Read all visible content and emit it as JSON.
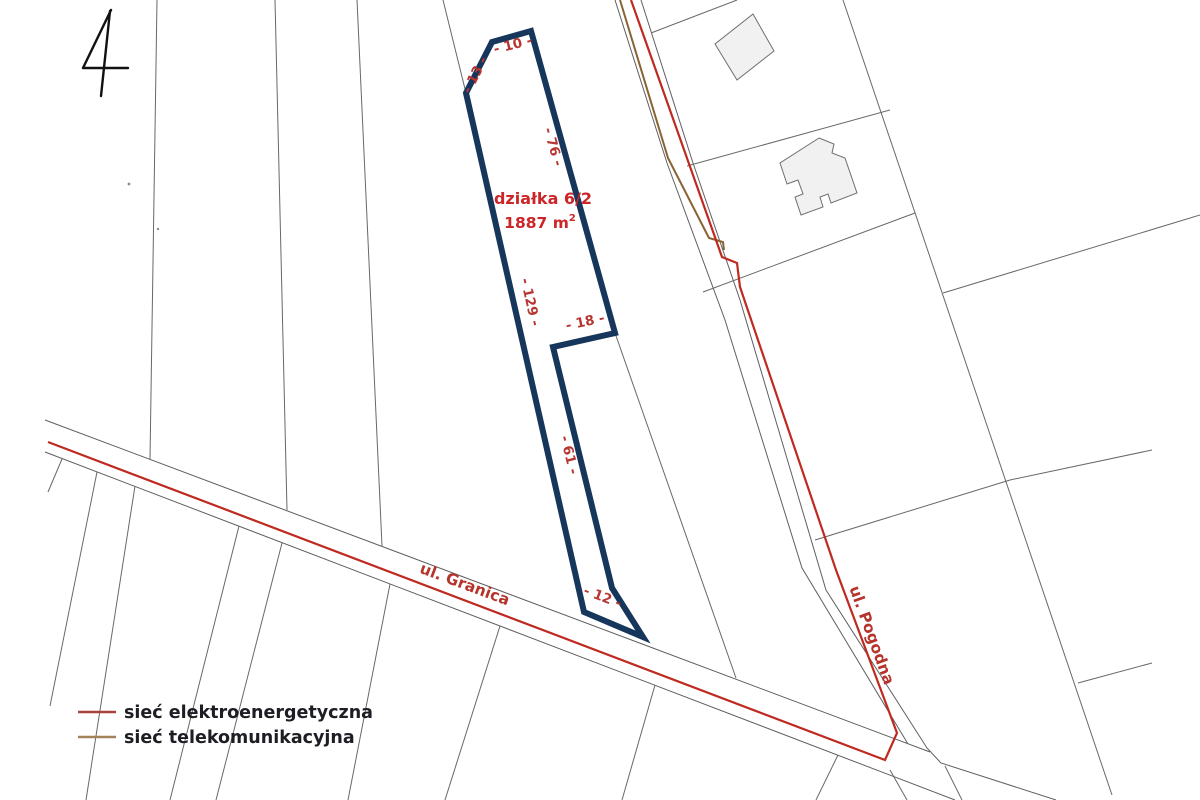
{
  "page_number": "4",
  "parcel": {
    "name": "działka 6/2",
    "area_main": "1887 m",
    "area_sup": "2",
    "dimensions": {
      "top": "- 10 -",
      "top_left": "- 13 -",
      "right": "- 76 -",
      "left": "- 129 -",
      "step": "- 18 -",
      "neck": "- 61 -",
      "bottom": "- 12 -"
    }
  },
  "streets": {
    "granica": "ul. Granica",
    "pogodna": "ul. Pogodna"
  },
  "legend": {
    "items": [
      {
        "label": "sieć elektroenergetyczna",
        "color": "#a8423c"
      },
      {
        "label": "sieć telekomunikacyjna",
        "color": "#a3835a"
      }
    ]
  },
  "colors": {
    "parcel_outline": "#16365c",
    "power_line": "#bf2a20",
    "telecom_line": "#8a6332",
    "dimension_text": "#b73631",
    "parcel_label": "#cc2629",
    "street_label": "#b5342c",
    "boundary": "#686868"
  }
}
